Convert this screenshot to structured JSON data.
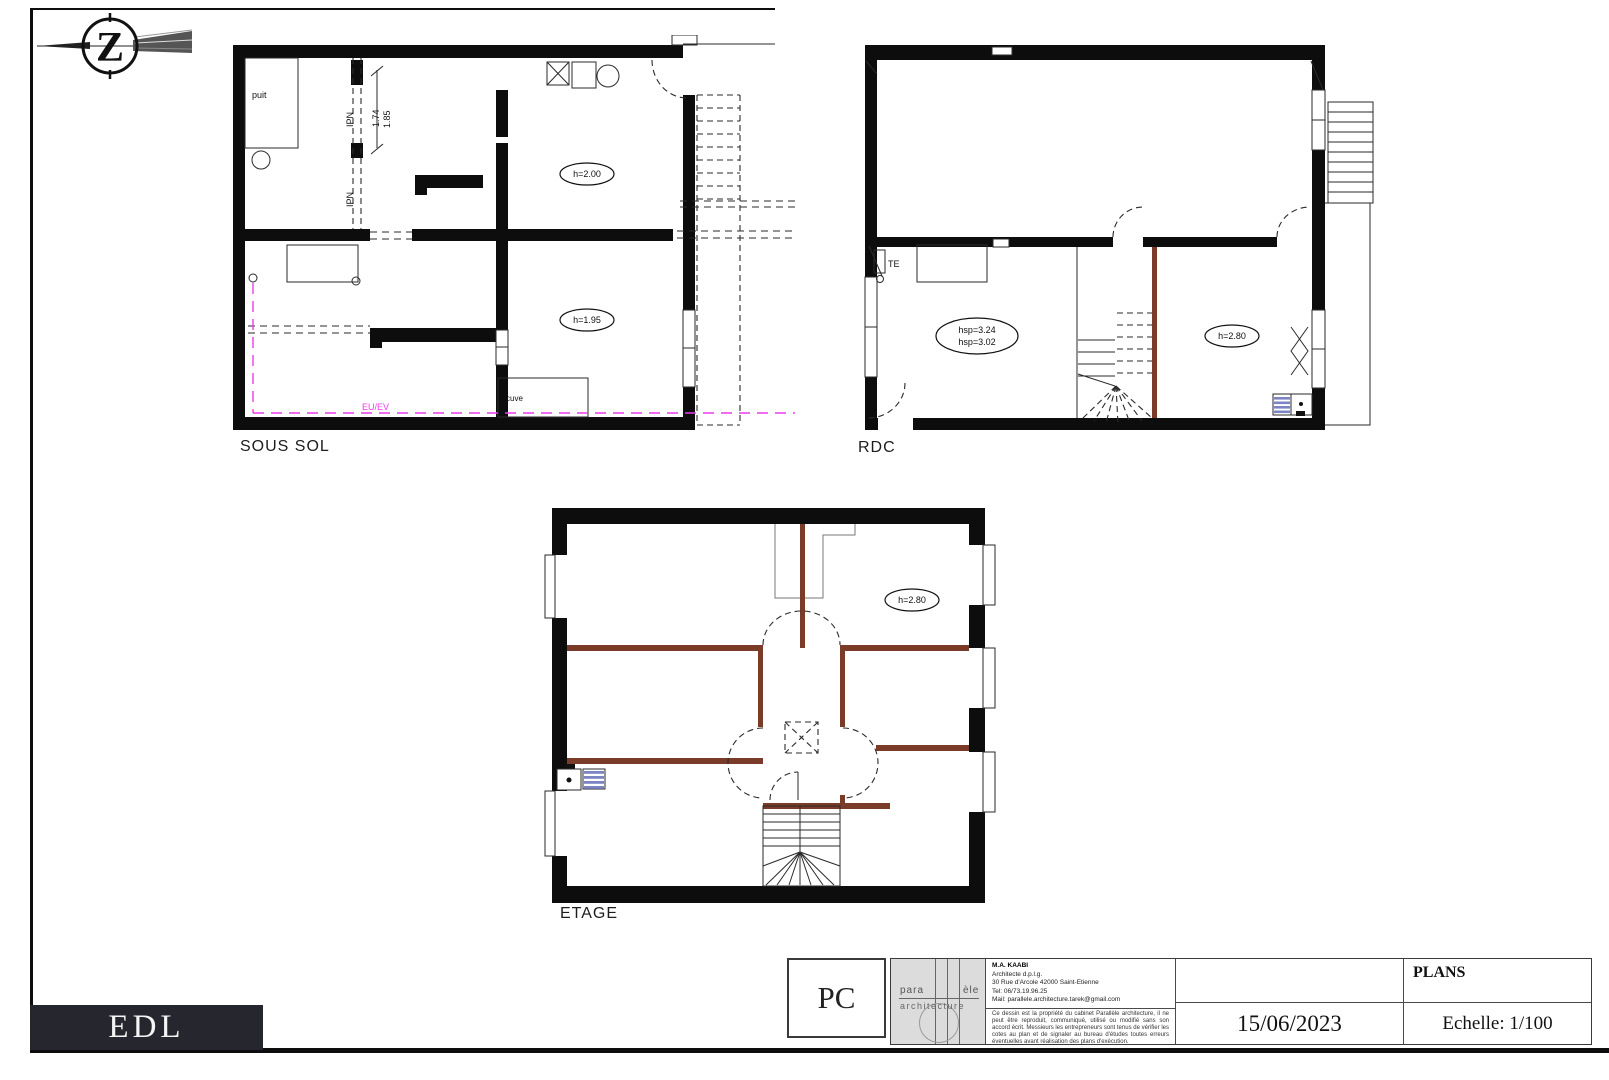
{
  "north_arrow": {
    "letter": "Z"
  },
  "plans": {
    "sous_sol": {
      "title": "SOUS SOL",
      "labels": {
        "puit": "puit",
        "ipn_top": "IPN",
        "ipn_bottom": "IPN",
        "dim_a": "1.74",
        "dim_b": "1.85",
        "h_upper": "h=2.00",
        "h_lower": "h=1.95",
        "cuve": "cuve",
        "eu_ev": "EU/EV"
      }
    },
    "rdc": {
      "title": "RDC",
      "labels": {
        "te": "TE",
        "hsp_line1": "hsp=3.24",
        "hsp_line2": "hsp=3.02",
        "h_room": "h=2.80"
      }
    },
    "etage": {
      "title": "ETAGE",
      "labels": {
        "h_room": "h=2.80"
      }
    }
  },
  "title_block": {
    "permit_code": "PC",
    "logo": {
      "word_start": "para",
      "word_end": "èle",
      "subtitle": "architecture"
    },
    "contact_lines": [
      "M.A. KAABI",
      "Architecte d.p.l.g.",
      "30 Rue d'Arcole 42000 Saint-Etienne",
      "Tel: 06/73.19.96.25",
      "Mail: parallele.architecture.tarek@gmail.com"
    ],
    "disclaimer": "Ce dessin est la propriété du cabinet Parallèle architecture, il ne peut être reproduit, communiqué, utilisé ou modifié sans son accord écrit. Messieurs les entrepreneurs sont tenus de vérifier les cotes au plan et de signaler au bureau d'études toutes erreurs éventuelles avant réalisation des plans d'exécution.",
    "doc_title": "PLANS",
    "date": "15/06/2023",
    "scale": "Echelle: 1/100"
  },
  "sheet_label": "EDL",
  "colors": {
    "wall": "#0d0d0d",
    "eu_ev": "#ee3cee",
    "wood": "#7a3b28",
    "sink": "#7d84c4"
  }
}
